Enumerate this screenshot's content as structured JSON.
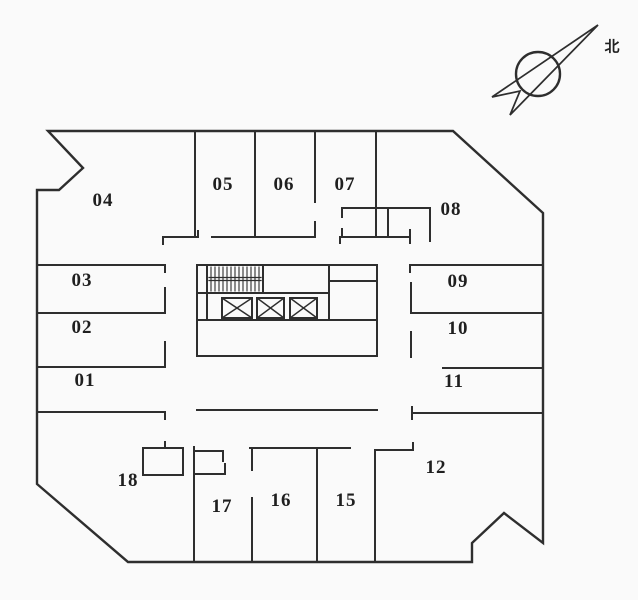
{
  "canvas": {
    "background": "#fafafa",
    "line_color": "#2e2e2e",
    "label_color": "#1f1f1f"
  },
  "compass": {
    "label": "北"
  },
  "rooms": [
    {
      "label": "01"
    },
    {
      "label": "02"
    },
    {
      "label": "03"
    },
    {
      "label": "04"
    },
    {
      "label": "05"
    },
    {
      "label": "06"
    },
    {
      "label": "07"
    },
    {
      "label": "08"
    },
    {
      "label": "09"
    },
    {
      "label": "10"
    },
    {
      "label": "11"
    },
    {
      "label": "12"
    },
    {
      "label": "15"
    },
    {
      "label": "16"
    },
    {
      "label": "17"
    },
    {
      "label": "18"
    }
  ],
  "core_symbols": {
    "elevator_count": 3,
    "stair_count": 1
  }
}
